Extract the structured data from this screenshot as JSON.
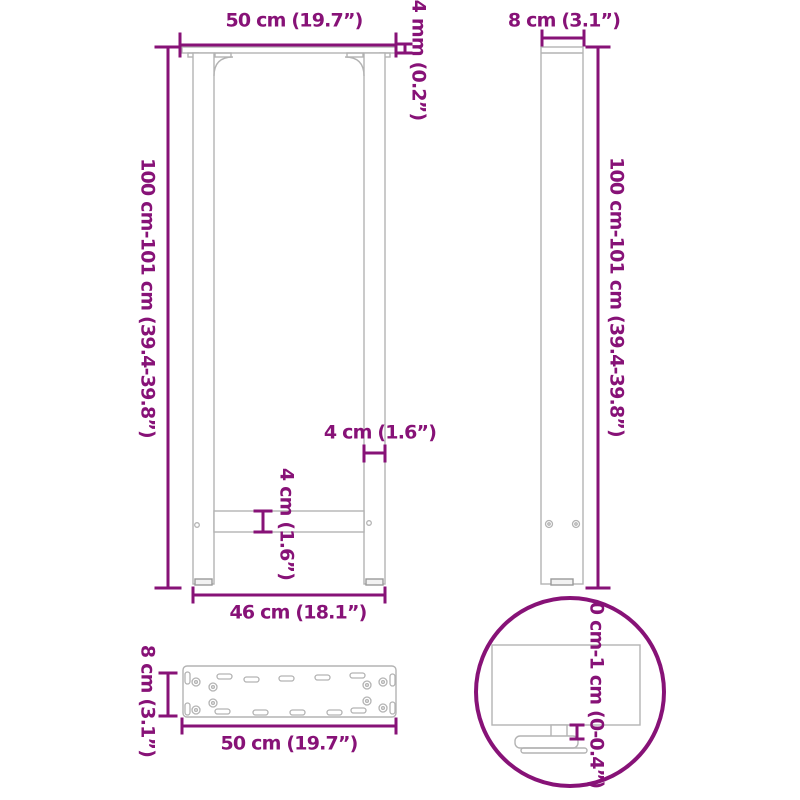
{
  "title": "Table leg dimension diagram",
  "colors": {
    "dimension": "#871277",
    "outline": "#b3b3b3",
    "outline_dark": "#999999"
  },
  "front_view": {
    "top_width": "50 cm (19.7”)",
    "plate_thickness": "4 mm (0.2”)",
    "height": "100 cm-101 cm (39.4-39.8”)",
    "leg_tube_width": "4 cm (1.6”)",
    "crossbar_height": "4 cm (1.6”)",
    "bottom_width": "46 cm (18.1”)"
  },
  "side_view": {
    "depth": "8 cm (3.1”)",
    "height": "100 cm-101 cm (39.4-39.8”)"
  },
  "plate_view": {
    "depth": "8 cm (3.1”)",
    "width": "50 cm (19.7”)"
  },
  "detail_view": {
    "height_adjustment": "0 cm-1 cm (0-0.4”)"
  }
}
